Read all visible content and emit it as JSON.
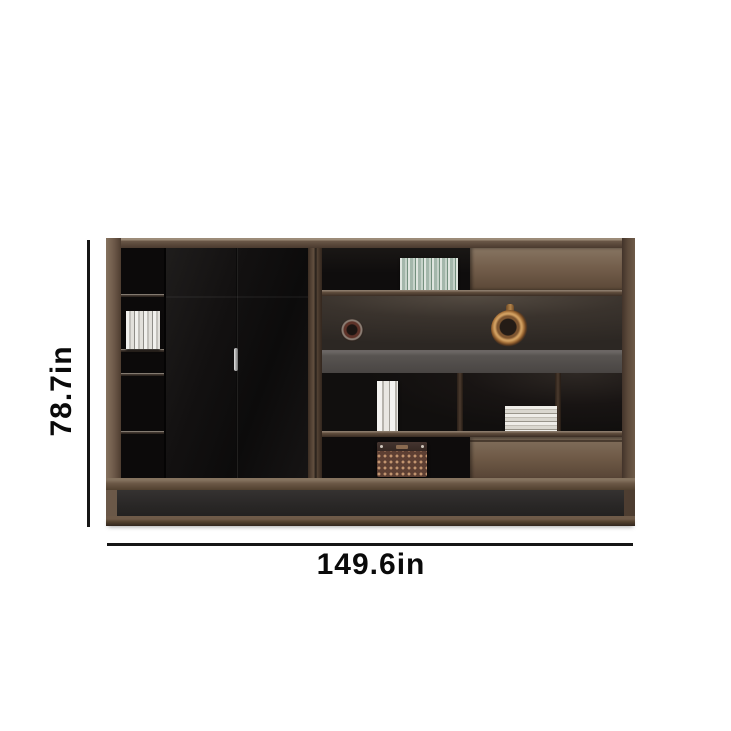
{
  "meta": {
    "description": "E-commerce product dimension image of a walnut and black office bookcase storage cabinet on a white background",
    "background_color": "#ffffff"
  },
  "annotations": {
    "height": {
      "label": "78.7in",
      "orientation": "vertical",
      "side": "left"
    },
    "width": {
      "label": "149.6in",
      "orientation": "horizontal",
      "side": "bottom"
    },
    "line_color": "#161616",
    "text_color": "#0a0a0a"
  },
  "palette": {
    "wood_frame": "#6b5747",
    "wood_panel_light": "#82705d",
    "door_black": "#131111",
    "interior_dark": "#0b0909",
    "gray_band": "#55504d",
    "base_dark": "#2a2827",
    "copper_accent": "#cf9e60",
    "basket_brown": "#5d3f33",
    "handle_silver": "#c9c9c9"
  },
  "scene_objects": {
    "left_column_books": "row of white books",
    "top_shelf_books": "row of striped books",
    "decor_small": "dark round ornament",
    "decor_large": "copper ring vase",
    "mid_shelf_books": "two standing books",
    "book_stack": "stack of books",
    "basket": "woven storage box",
    "doors": "two black cabinet doors",
    "sliding_panel": "walnut sliding panel",
    "drawer": "walnut drawer front"
  }
}
